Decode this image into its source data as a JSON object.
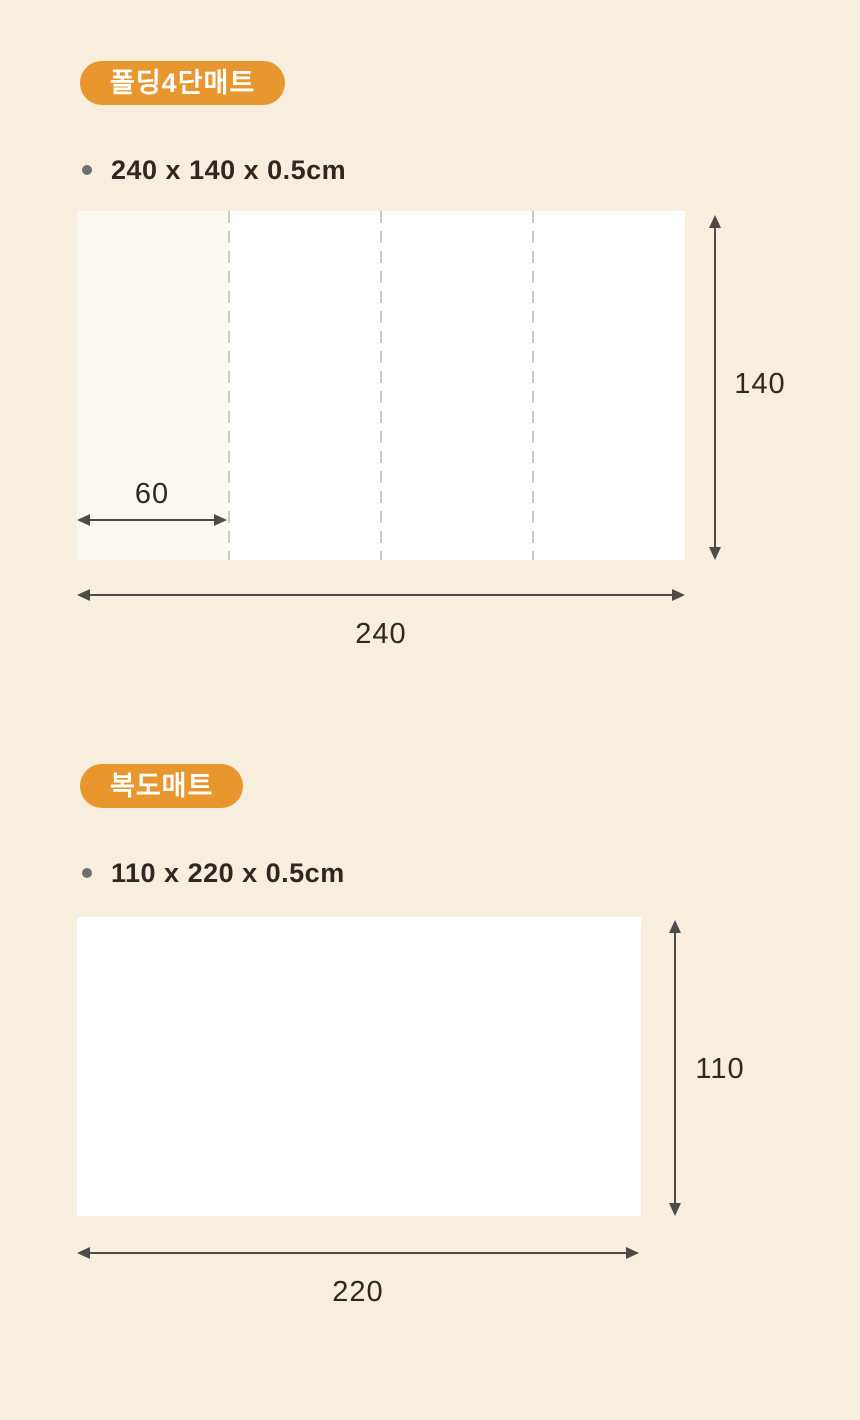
{
  "colors": {
    "background": "#F8EEDD",
    "badge": "#E8962E",
    "badge_text": "#FFFFFF",
    "text": "#2E2820",
    "arrow": "#4D4B47",
    "dash": "#CBCBC8",
    "mat": "#FFFFFF",
    "mat_panel_tint": "#FAF8F1",
    "bullet": "#6F6F6F"
  },
  "sections": [
    {
      "badge": "폴딩4단매트",
      "spec": "240 x 140 x 0.5cm",
      "diagram": {
        "panels": 4,
        "panel_width_label": "60",
        "height_label": "140",
        "width_label": "240"
      }
    },
    {
      "badge": "복도매트",
      "spec": "110 x 220 x 0.5cm",
      "diagram": {
        "panels": 1,
        "height_label": "110",
        "width_label": "220"
      }
    }
  ]
}
